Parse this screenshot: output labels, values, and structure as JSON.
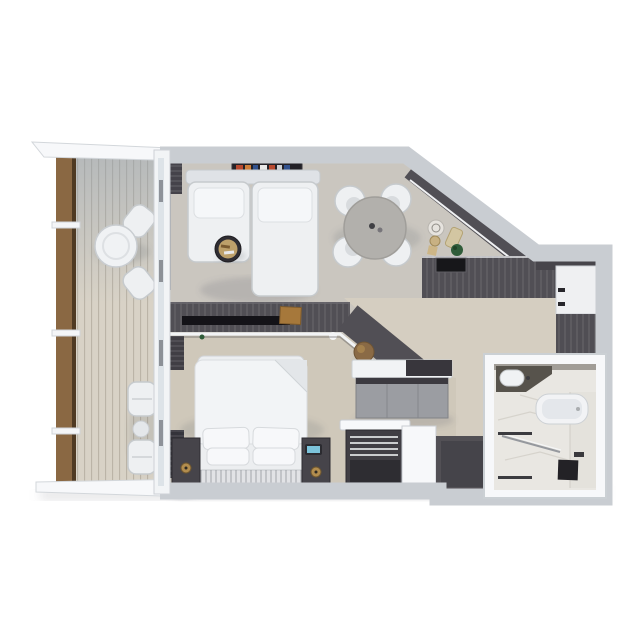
{
  "scene": {
    "type": "3d_floor_plan_render",
    "view": "top_down",
    "rooms": [
      {
        "id": "balcony",
        "furniture": [
          "wood-railing",
          "bistro-table",
          "bistro-chair",
          "bistro-chair",
          "lounge-chair",
          "lounge-chair",
          "side-table"
        ]
      },
      {
        "id": "living-room",
        "furniture": [
          "wall-shelf-with-books",
          "sectional-sofa",
          "round-tray-table",
          "dining-table",
          "dining-chair",
          "dining-chair",
          "dining-chair",
          "dining-chair"
        ]
      },
      {
        "id": "kitchen",
        "furniture": [
          "angled-counter",
          "base-cabinets",
          "sink",
          "plate",
          "cutting-board",
          "plant",
          "tray"
        ]
      },
      {
        "id": "bedroom",
        "furniture": [
          "double-bed",
          "pillows",
          "headboard",
          "nightstand-left",
          "nightstand-right",
          "lamp",
          "lamp",
          "alarm-clock",
          "curtains"
        ]
      },
      {
        "id": "divider",
        "furniture": [
          "media-console",
          "tv-panel",
          "wood-box",
          "decor-bowl",
          "wood-stool",
          "glass-screen"
        ]
      },
      {
        "id": "corridor",
        "furniture": [
          "dresser-desk",
          "wardrobe-panels",
          "paneled-door"
        ]
      },
      {
        "id": "entry",
        "furniture": [
          "luggage-bench",
          "partition-wall",
          "door-mat"
        ]
      },
      {
        "id": "bathroom",
        "furniture": [
          "vanity-sink",
          "bathtub",
          "glass-shower-screen",
          "shower-tray",
          "towel-bar",
          "towel-bar",
          "marble-wall"
        ]
      }
    ]
  },
  "colors": {
    "wall": "#f7f8fa",
    "wall_edge": "#c9cdd2",
    "carpet_living": "#cac6bf",
    "carpet_bedroom": "#cfc8ba",
    "floor_corridor": "#d5cec1",
    "deck": "#d8d2c6",
    "wood_rail": "#8a6843",
    "cabinet_dark": "#514f55",
    "furniture_white": "#eef0f2",
    "furniture_edge": "#c6cacd",
    "marble": "#e9e7e2",
    "marble_vein": "#d6d3cc",
    "glass": "#dde3e8",
    "table_gray": "#b2b0ac",
    "mat_dark": "#525055",
    "tan_wood": "#bda06a",
    "plant_green": "#2f5c39",
    "clock_blue": "#7cc3da",
    "lamp_gold": "#b28d4e",
    "book_red": "#b8492f",
    "book_orange": "#d07f3a",
    "book_blue": "#32528e"
  }
}
